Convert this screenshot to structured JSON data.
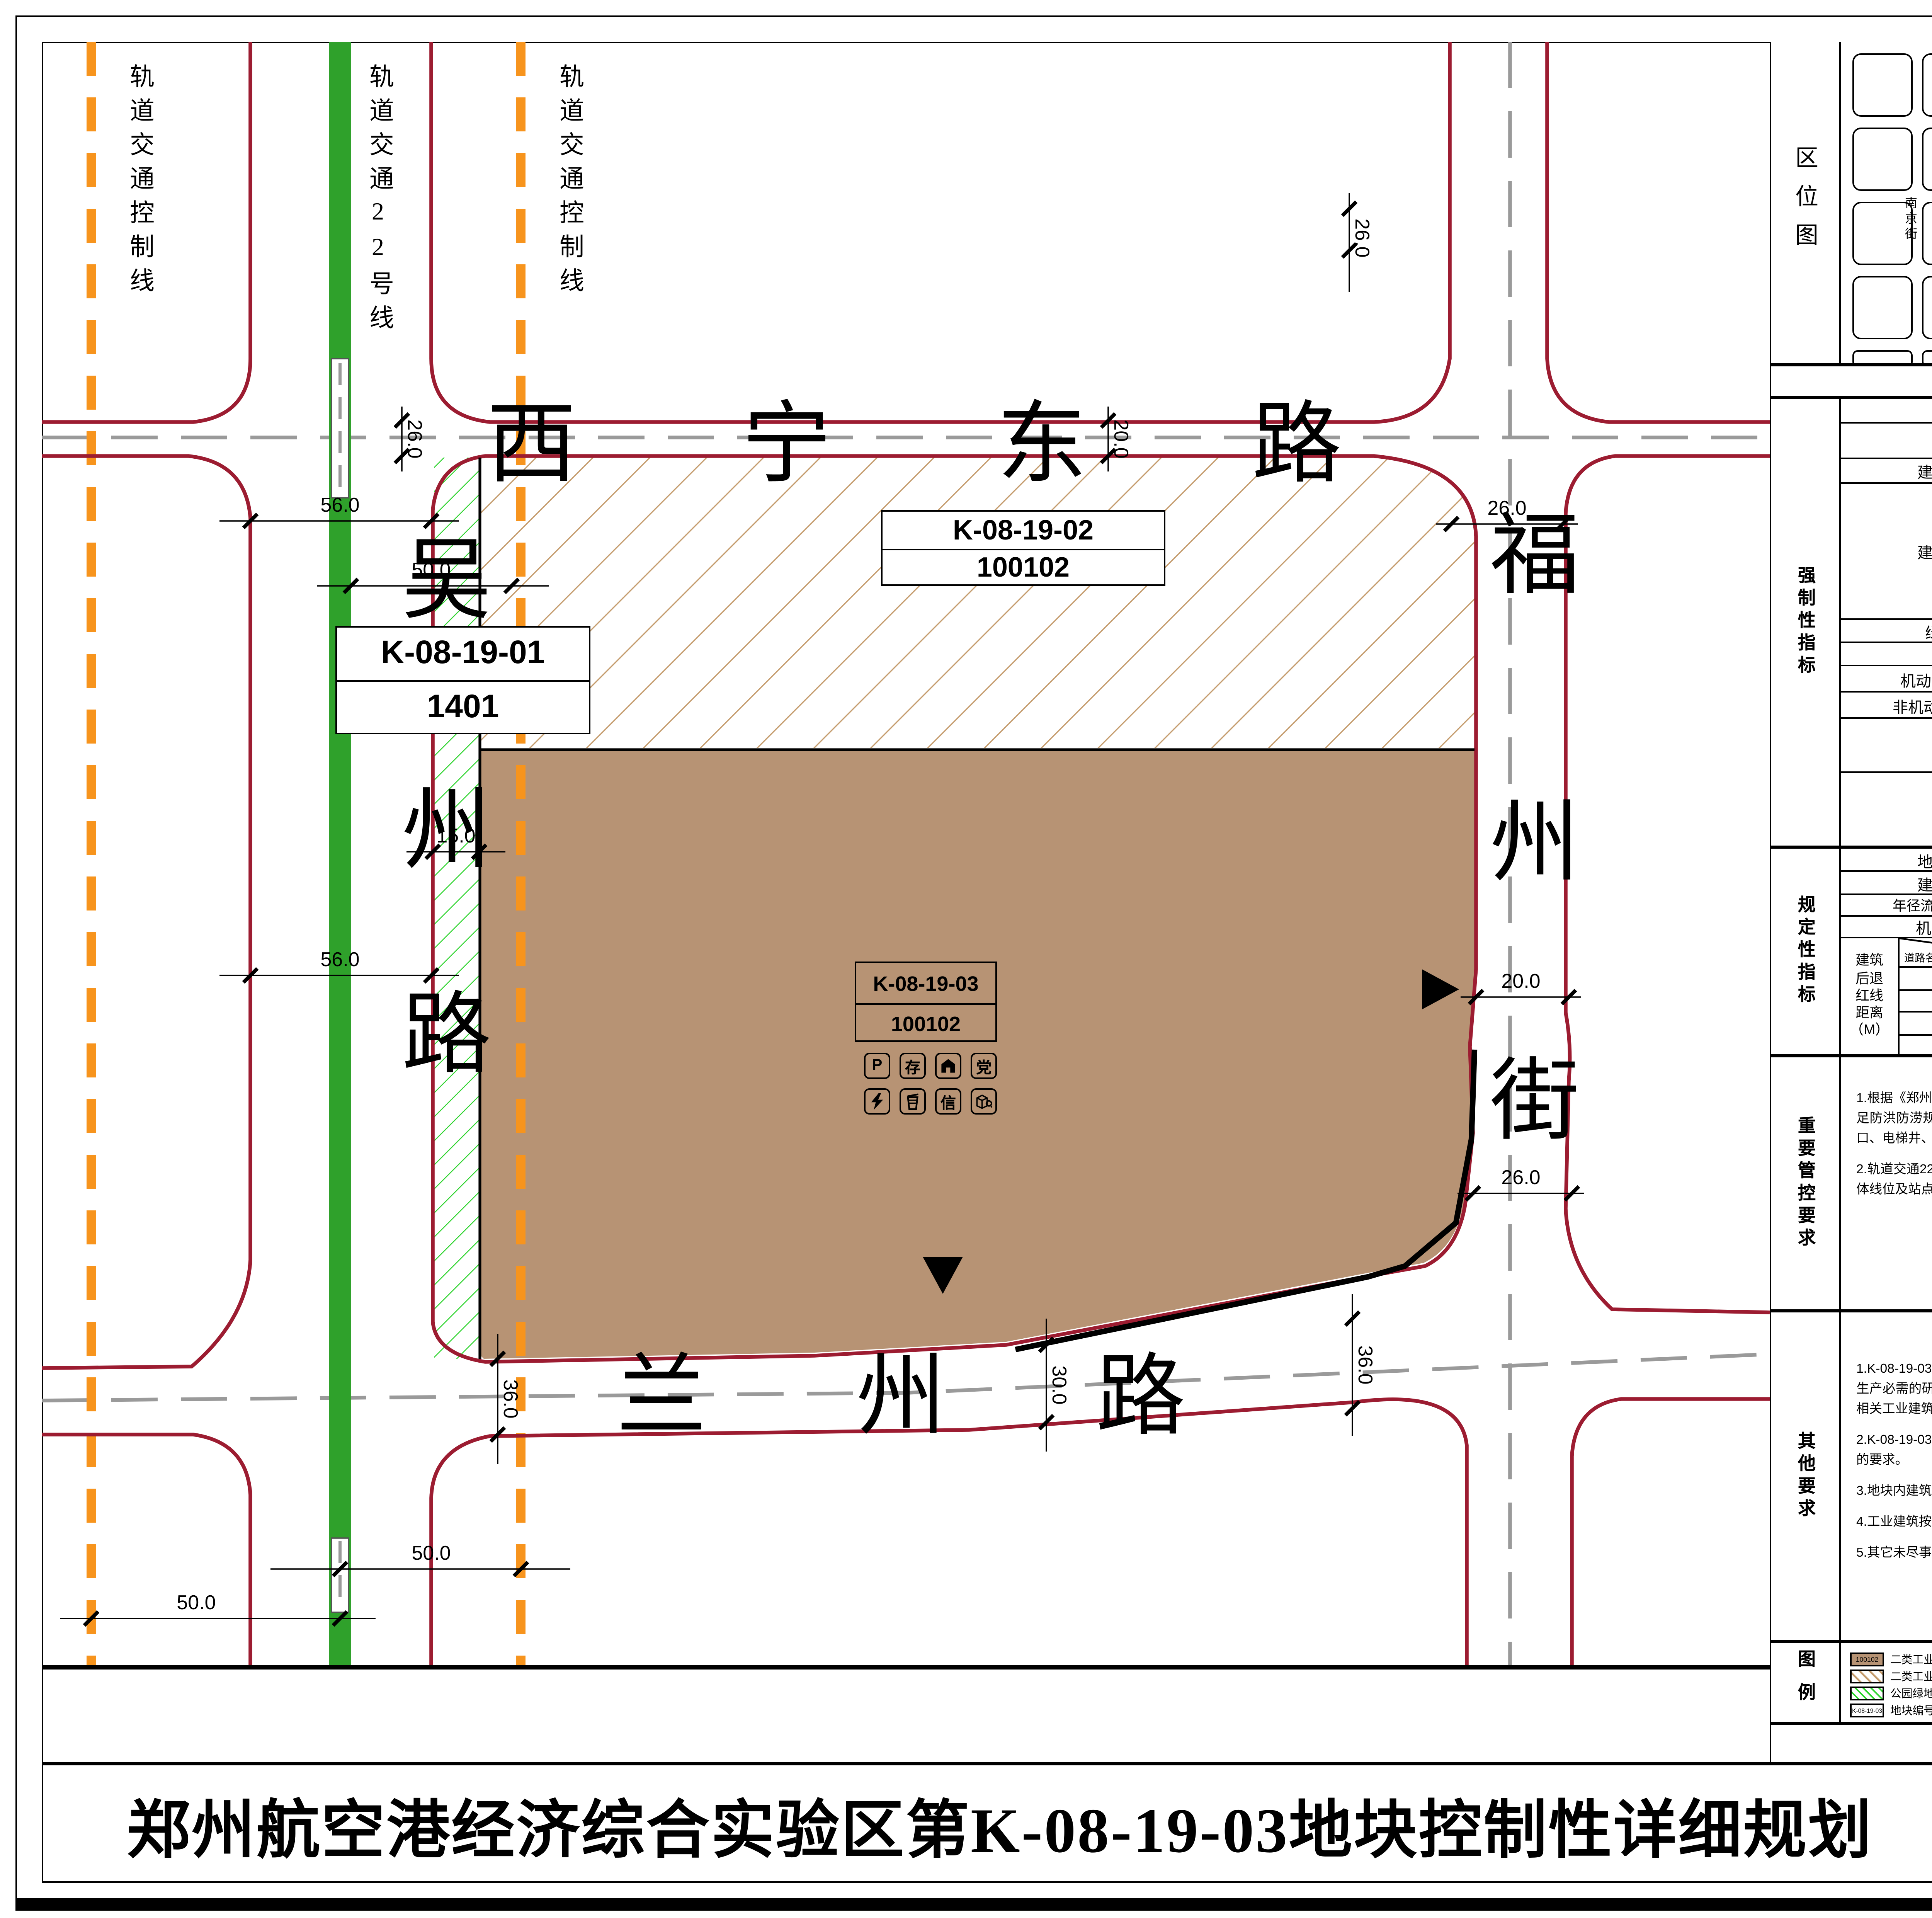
{
  "sheet": {
    "title": "郑州航空港经济综合实验区第K-08-19-03地块控制性详细规划",
    "sheet_type": "地上图则",
    "page_number": "10"
  },
  "map": {
    "corridor_labels": [
      "轨道交通控制线",
      "轨道交通22号线",
      "轨道交通控制线"
    ],
    "road_north": "西宁东路",
    "road_south": "兰州路",
    "road_west_chars": [
      "吴",
      "州",
      "路"
    ],
    "road_east_chars": [
      "福",
      "州",
      "街"
    ],
    "dims": [
      "26.0",
      "20.0",
      "26.0",
      "26.0",
      "20.0",
      "26.0",
      "56.0",
      "50.0",
      "15.0",
      "56.0",
      "36.0",
      "30.0",
      "36.0",
      "50.0",
      "50.0"
    ],
    "parcel1_code": "K-08-19-01",
    "parcel1_use": "1401",
    "parcel2_code": "K-08-19-02",
    "parcel2_use": "100102",
    "parcel3_code": "K-08-19-03",
    "parcel3_use": "100102",
    "icon_p": "P",
    "icon_cun": "存",
    "icon_dang": "党",
    "icon_xin": "信"
  },
  "location_map": {
    "label": "区位图",
    "block_label": "街坊编号",
    "block_no": "K-08-19",
    "north_mark": "N",
    "scale_ticks": [
      "0",
      "20",
      "40",
      "80M"
    ],
    "scale_text": "1:2000",
    "h_streets": [
      "苏秦路",
      "西宁东路",
      "兰州路",
      "拉萨东路"
    ],
    "v_streets": [
      "南京街",
      "上海街",
      "吴州路",
      "福州街",
      "台北街",
      "翔航东街"
    ]
  },
  "indicators": {
    "title": "K-08-19-03地块控制性指标",
    "sections": {
      "mandatory": "强制性指标",
      "prescriptive": "规定性指标",
      "control": "重要管控要求",
      "other": "其他要求",
      "legend": "图例"
    },
    "rows": [
      {
        "label": "地块编码",
        "value": "K-08-19-03"
      },
      {
        "label": "用地性质",
        "value": "二类工业用地（100102）"
      },
      {
        "label": "建筑系数",
        "unit": "%",
        "value": ">40"
      },
      {
        "label": "建筑高度",
        "unit": "M",
        "value": "<80(其中生产性用房<50M)，且须符合机场管理机构关于项目核准净空高度的复函"
      },
      {
        "label": "绿地率",
        "unit": "%",
        "value": ">10，<20"
      },
      {
        "label": "容积率",
        "value": ">1.5，<3.0"
      },
      {
        "label": "机动车停车位配建标准",
        "value": "见其他要求"
      },
      {
        "label": "非机动车停车位配建标准",
        "value": "见其他要求"
      },
      {
        "label": "日照间距",
        "value": "日照间距标准应符合国家相关规范及《郑州市城市规划管理技术规定》等有关规定要求。"
      },
      {
        "label": "防火间距",
        "value": "防火间距标准应符合《建筑设计防火规范（GB 50016-2014）》（2018年版）和《建筑防火通用规范（GB 55037-2022）》的有关规定。"
      },
      {
        "label": "地块面积",
        "unit": "M²",
        "value": "50730"
      },
      {
        "label": "建筑面积",
        "unit": "M²",
        "value": ">76095，<152190"
      },
      {
        "label": "年径流总量控制率",
        "unit": "%",
        "value": "≥60"
      },
      {
        "label": "机动车出入口方向",
        "value": "东、南"
      }
    ],
    "setback": {
      "label": "建筑后退红线距离（M）",
      "corner_top": "建筑高度H",
      "corner_unit": "（M）",
      "corner_bottom": "道路名称",
      "cols": [
        "H≤24",
        "24<H≤60",
        "60<H≤100"
      ],
      "rows": [
        {
          "road": "吴州路（50M）",
          "v": [
            "≥15",
            "≥20",
            "≥25"
          ]
        },
        {
          "road": "兰州路（30M）",
          "v": [
            "≥10",
            "≥15",
            "≥20"
          ]
        },
        {
          "road": "福州街（20M）",
          "v": [
            "≥10",
            "≥15",
            "≥15"
          ]
        },
        {
          "road": "西宁东路（30M）",
          "v": [
            "≥10",
            "≥15",
            "≥15"
          ]
        }
      ]
    },
    "control_items": [
      "1.根据《郑州市自然资源和规划局关于加强防洪防涝规划管理工作的通知(试行)》的要求，变电室、开闭所、通信综合接入机房应布置在地上并满足防洪防涝规划建设要求，热交换站、供水二次加压泵房、电梯、供水设施、雨污水提升设施、应急照明、消控中心、地下空间出入口、通风口、电梯井、楼梯间等设施应按照防洪防涝规划建设要求实施。",
      "2.轨道交通22号线沿吴州路敷设，两侧各控制50米的轨道交通控制线，轨道交通控制线范围内的建构筑物须征求轨道交通部门意见。轨道交通具体线位及站点以政府最终审批通过的成果为准。"
    ],
    "other_items": [
      "1.K-08-19-03地块行政办公及生活服务设施用地面积不应大于工业项目总用地面积的7%，且建筑面积不应大于工业项目总建筑面积的15%。工业生产必需的研发、设计、检测、中试设施，可在行政办公及生活服务设施之外计算，且建筑面积不应大于工业项目总建筑面积的15%，并要符合相关工业建筑设计规范要求。严禁在工业项目用地范围内建造成套住宅、专家楼、宾馆、招待所和培训中心等非生产性配套设施。",
      "2.K-08-19-03地块内机动车配建、非机动车配建应符合《郑州市城市规划管理技术规定》和《河南省加快电动汽车充电基础设施建设的若干政策》的要求。",
      "3.地块内建筑应满足《郑州市城市规划管理技术规定》中后退道路红线、绿线及地界的要求。",
      "4.工业建筑按照《绿色工业建筑评价标准》GB/T 50878-2013绿色建筑标准进行建设。",
      "5.其它未尽事宜按照河南省、郑州市相关规范、政策文件要求及《郑州市城市规划管理技术规定》执行。"
    ]
  },
  "legend": {
    "items": [
      "二类工业用地",
      "二类工业用地",
      "公园绿地",
      "地块编号",
      "道路中线",
      "地块界线",
      "尺寸标注",
      "道路红线",
      "轨道交通线",
      "轨道交通控制线",
      "禁止机动车开口段",
      "机动车出入口方位",
      "机动车停车场(库)",
      "非机动车存车处",
      "垃圾收集点",
      "楼宇党组织工作用房",
      "物业管理用房",
      "通信接入机房",
      "变电室",
      "邮件和快递送达设施"
    ],
    "samples": {
      "industrial_code": "100102",
      "parcel_code": "K-08-19-03",
      "dim": "50.0"
    },
    "glyphs": {
      "parking": "P",
      "bike": "存",
      "party": "党",
      "telecom": "信"
    }
  }
}
